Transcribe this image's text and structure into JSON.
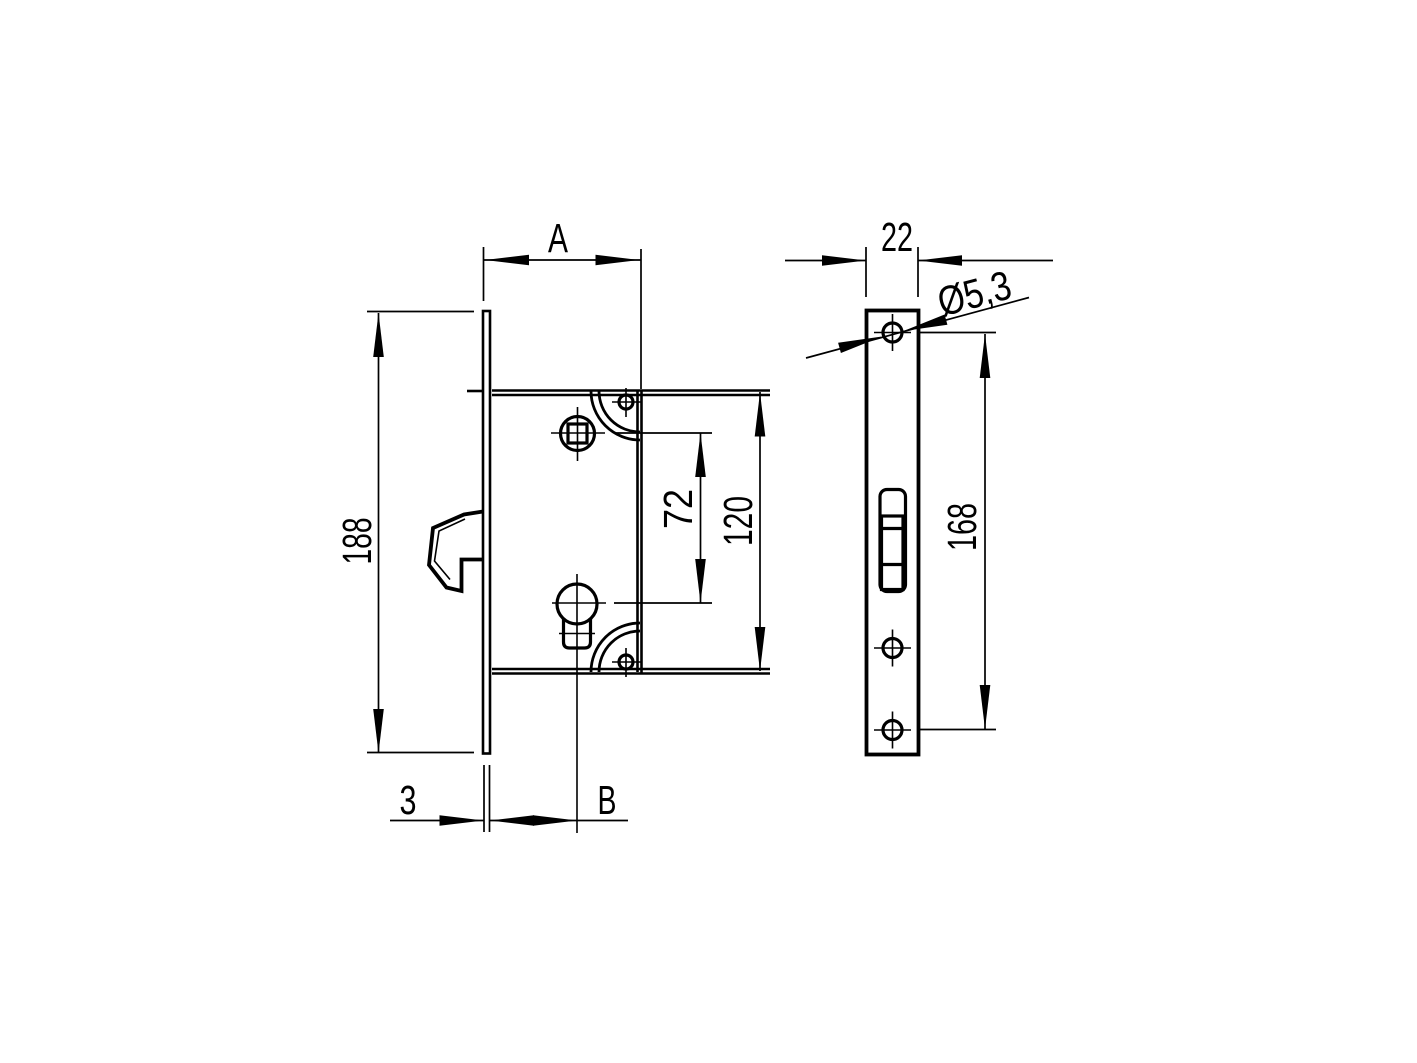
{
  "page": {
    "background": "#ffffff",
    "line_color": "#000000"
  },
  "drawing": {
    "type": "technical-drawing",
    "subject": "mortise hook lock with euro profile cylinder, dimensioned front and side views",
    "views": {
      "front": {
        "dims": {
          "case_width_label": "A",
          "faceplate_height": "188",
          "spindle_to_cylinder": "72",
          "case_height": "120",
          "faceplate_thickness": "3",
          "backset_label": "B"
        }
      },
      "side": {
        "dims": {
          "faceplate_width": "22",
          "hole_diameter": "Ø5,3",
          "screw_spacing": "168"
        }
      }
    }
  }
}
